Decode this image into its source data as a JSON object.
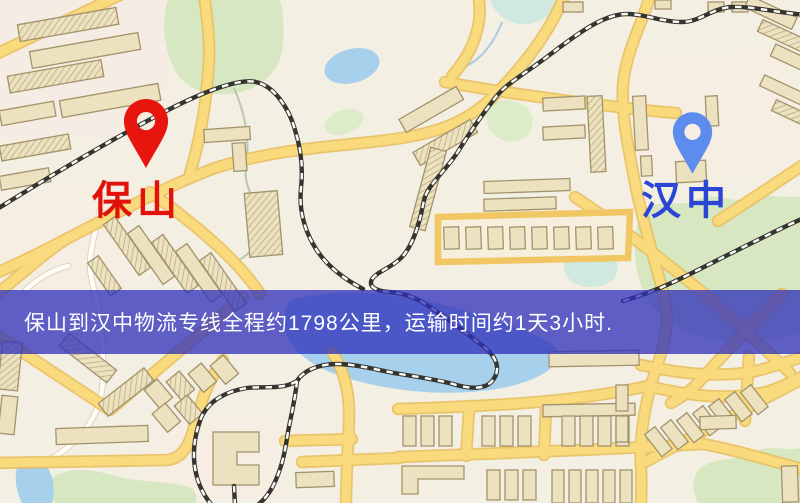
{
  "banner": {
    "text": "保山到汉中物流专线全程约1798公里，运输时间约1天3小时.",
    "background": "rgba(47,49,187,0.76)",
    "text_color": "#ffffff"
  },
  "route": {
    "origin": "保山",
    "destination": "汉中",
    "distance_km": "1798",
    "duration_text": "1天3小时"
  },
  "markers": {
    "origin": {
      "label": "保山",
      "pin_color": "#e8150e",
      "label_color": "#e01209"
    },
    "destination": {
      "label": "汉中",
      "pin_color": "#5c8cee",
      "label_color": "#2b46d4"
    }
  }
}
